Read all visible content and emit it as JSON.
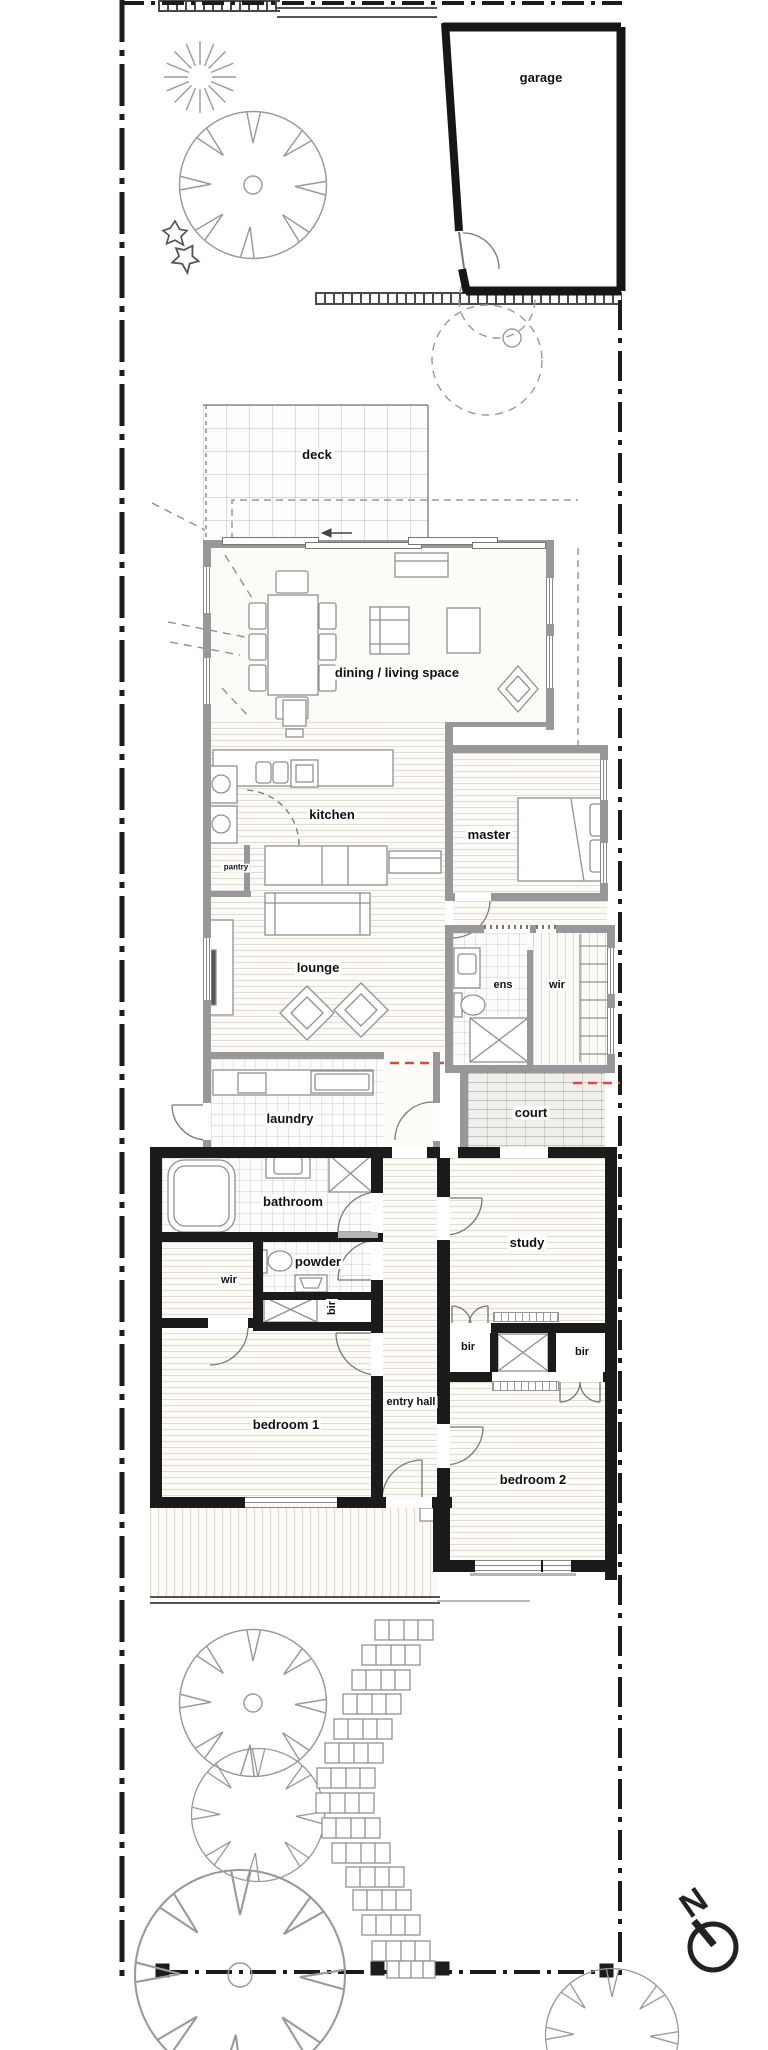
{
  "drawing": {
    "kind": "architectural site floor plan"
  },
  "rooms": {
    "garage": "garage",
    "deck": "deck",
    "living": "dining / living space",
    "kitchen": "kitchen",
    "pantry": "pantry",
    "master": "master",
    "lounge": "lounge",
    "ens": "ens",
    "wir_master": "wir",
    "laundry": "laundry",
    "court": "court",
    "bathroom": "bathroom",
    "powder": "powder",
    "wir_existing": "wir",
    "bir_hall": "bir",
    "bedroom1": "bedroom 1",
    "entry_hall": "entry hall",
    "study": "study",
    "bir_left": "bir",
    "bir_right": "bir",
    "bedroom2": "bedroom 2"
  },
  "compass": {
    "north_label": "N"
  },
  "colors": {
    "wall_new": "#98989a",
    "wall_existing": "#1b1b1b",
    "demolition_line": "#d84b3e",
    "tree_line": "#9a9a9a",
    "paper": "#ffffff"
  }
}
